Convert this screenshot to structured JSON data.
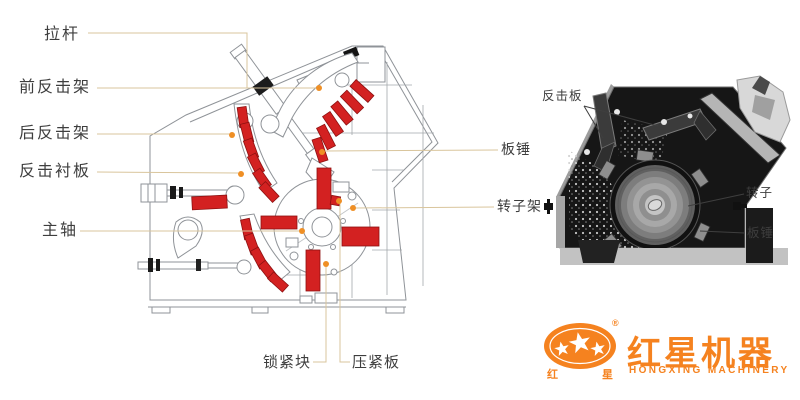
{
  "left_figure": {
    "label_pull_rod": "拉杆",
    "label_front_impact_frame": "前反击架",
    "label_rear_impact_frame": "后反击架",
    "label_impact_lining_plate": "反击衬板",
    "label_main_shaft": "主轴",
    "label_blow_bar": "板锤",
    "label_rotor_frame": "转子架",
    "label_locking_block": "锁紧块",
    "label_pressing_plate": "压紧板"
  },
  "right_figure": {
    "label_impact_plate": "反击板",
    "label_rotor": "转子",
    "label_blow_bar": "板锤"
  },
  "logo": {
    "brand_cn": "红星机器",
    "brand_en": "HONGXING MACHINERY",
    "seal_left": "红",
    "seal_right": "星",
    "registered_mark": "®",
    "color": "#f5821f"
  },
  "colors": {
    "highlight_red": "#d32121",
    "leader_line": "#d9c59c",
    "callout_dot": "#ef8f25",
    "line_art": "#8f9398"
  }
}
